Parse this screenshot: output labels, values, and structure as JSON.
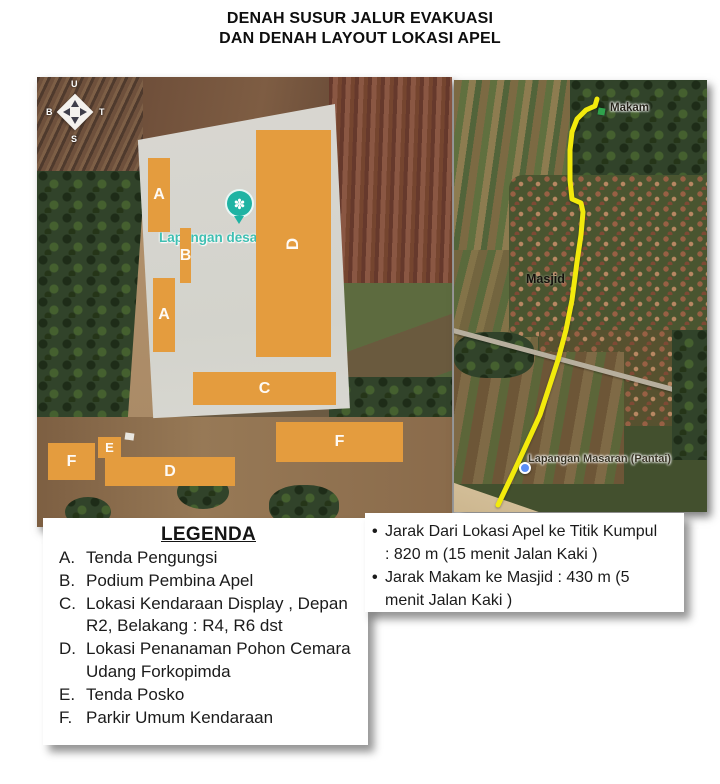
{
  "title": {
    "line1": "DENAH SUSUR JALUR EVAKUASI",
    "line2": "DAN DENAH LAYOUT LOKASI APEL"
  },
  "maps": {
    "left": {
      "compass": {
        "north": "U",
        "south": "S",
        "west": "B",
        "east": "T"
      },
      "field_label": "Lapangan desa",
      "pin_glyph": "✽",
      "zones": [
        {
          "label": "A"
        },
        {
          "label": "B"
        },
        {
          "label": "A"
        },
        {
          "label": "D"
        },
        {
          "label": "C"
        },
        {
          "label": "E"
        },
        {
          "label": "F"
        },
        {
          "label": "D"
        },
        {
          "label": "F"
        }
      ],
      "zone_color": "#E49C3E"
    },
    "right": {
      "labels": {
        "makam": "Makam",
        "masjid": "Masjid",
        "lapangan": "Lapangan Masaran (Pantai)"
      },
      "route_color": "#F2EA0C",
      "marker_color": "#2FA24C"
    }
  },
  "legend": {
    "heading": "LEGENDA",
    "items": [
      {
        "letter": "A.",
        "text": "Tenda Pengungsi"
      },
      {
        "letter": "B.",
        "text": "Podium Pembina Apel"
      },
      {
        "letter": "C.",
        "text": "Lokasi Kendaraan Display , Depan\nR2, Belakang : R4, R6 dst"
      },
      {
        "letter": "D.",
        "text": "Lokasi Penanaman Pohon Cemara\nUdang Forkopimda"
      },
      {
        "letter": "E.",
        "text": "Tenda Posko"
      },
      {
        "letter": "F.",
        "text": "Parkir Umum Kendaraan"
      }
    ]
  },
  "notes": {
    "bullet": "•",
    "items": [
      {
        "text": "Jarak Dari Lokasi Apel ke Titik Kumpul\n: 820 m (15 menit Jalan Kaki )"
      },
      {
        "text": "Jarak Makam ke Masjid : 430 m (5\nmenit Jalan Kaki )"
      }
    ]
  }
}
